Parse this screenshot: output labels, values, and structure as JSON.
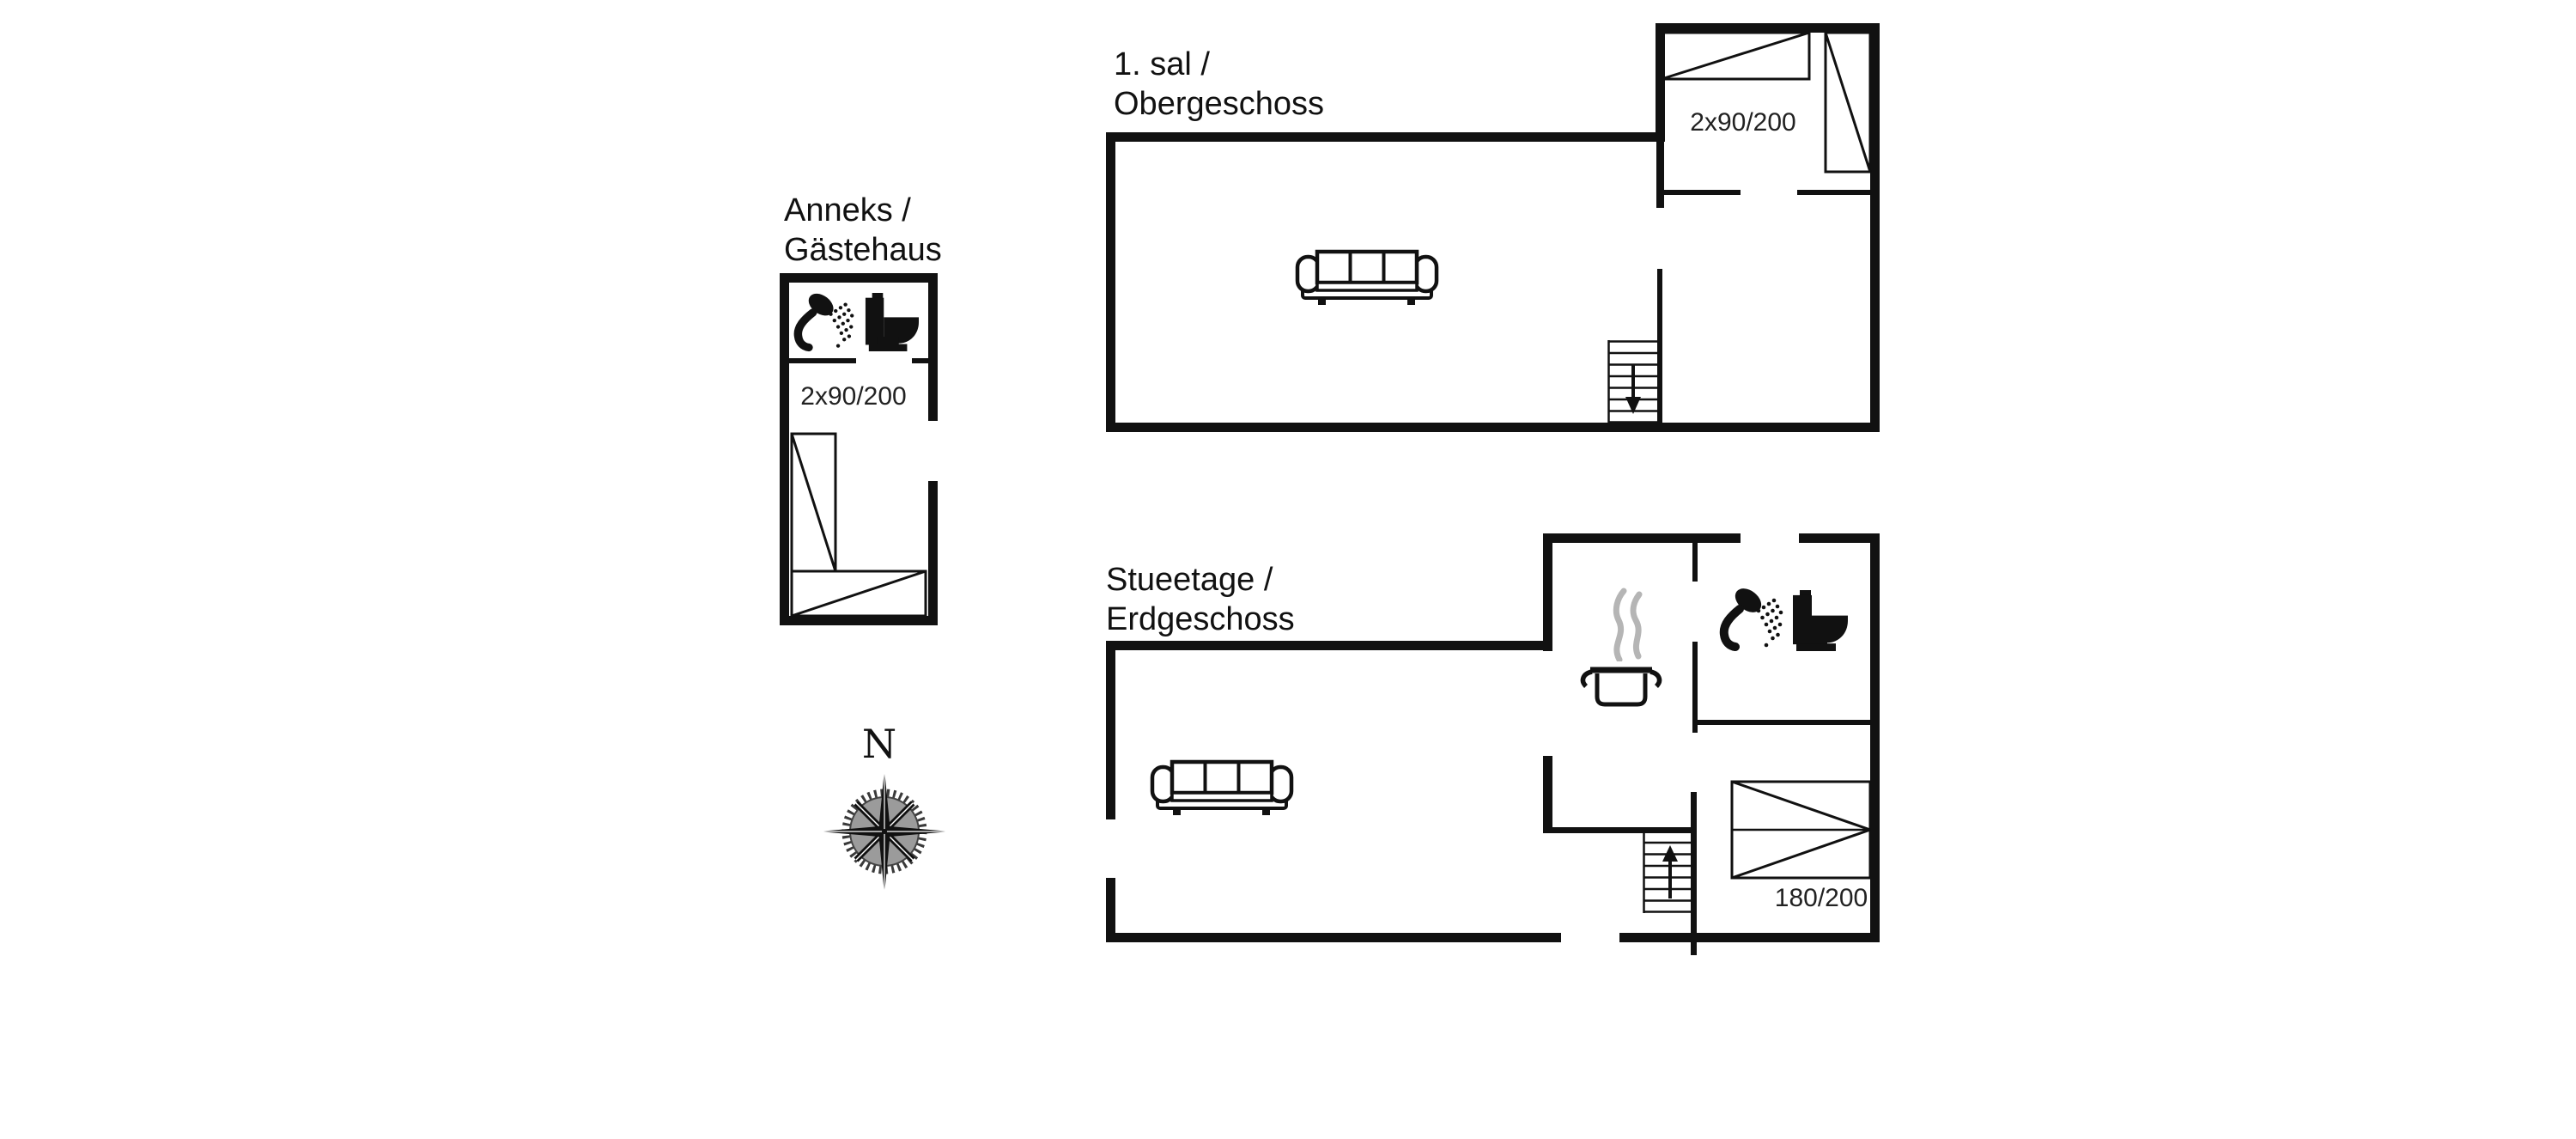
{
  "document": {
    "type": "holiday-house floor plan",
    "background_color": "#ffffff",
    "line_color": "#111111",
    "steam_color": "#b5b5b5"
  },
  "floors": {
    "upper": {
      "title_line1": "1. sal /",
      "title_line2": "Obergeschoss",
      "bed_label": "2x90/200"
    },
    "ground": {
      "title_line1": "Stueetage /",
      "title_line2": "Erdgeschoss",
      "bed_label": "180/200"
    },
    "annex": {
      "title_line1": "Anneks /",
      "title_line2": "Gästehaus",
      "bed_label": "2x90/200"
    }
  },
  "compass": {
    "north_label": "N"
  },
  "icons": {
    "shower": "shower-icon",
    "toilet": "toilet-icon",
    "cooking_pot": "cooking-pot-icon",
    "steam": "steam-icon",
    "sofa": "sofa-icon",
    "bed": "bed-icon",
    "stairs_down": "stairs-down-icon",
    "stairs_up": "stairs-up-icon",
    "compass_rose": "compass-rose-icon"
  }
}
